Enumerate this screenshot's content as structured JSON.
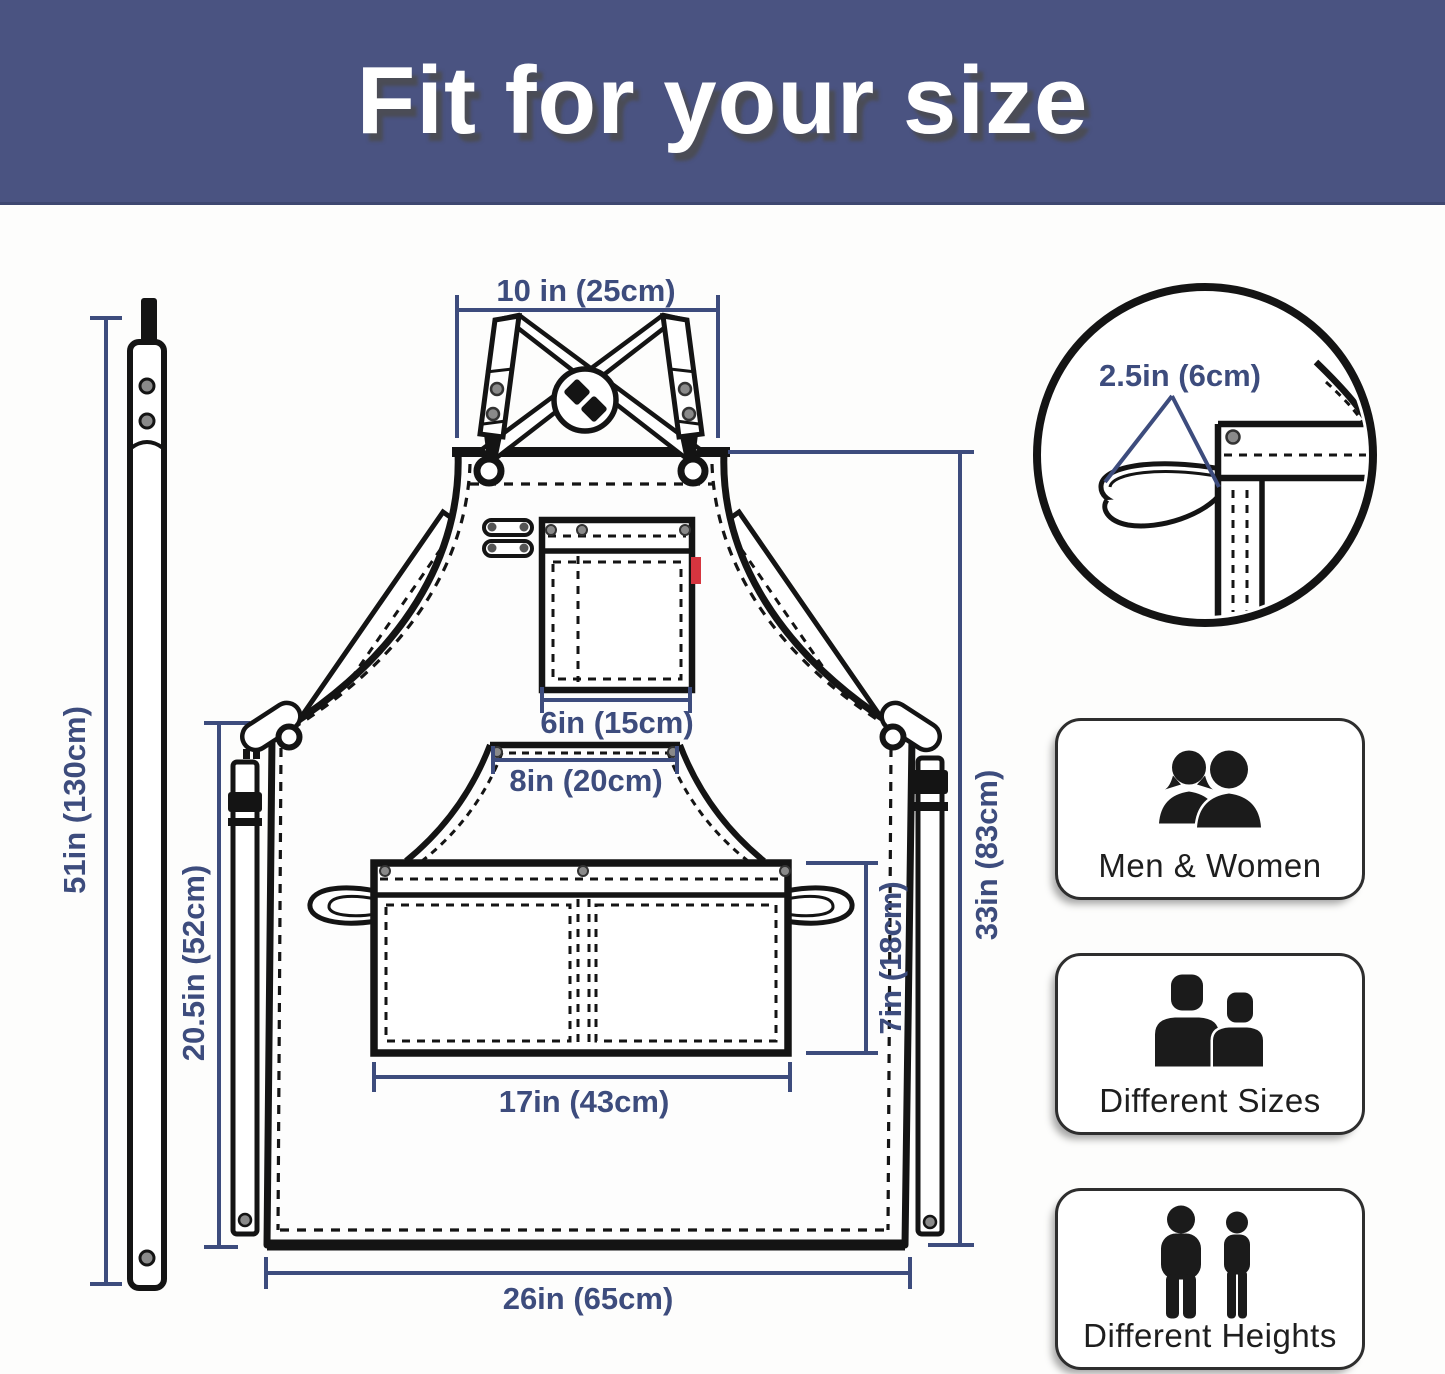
{
  "header": {
    "title": "Fit for your size"
  },
  "colors": {
    "banner_bg": "#4a5381",
    "dimension_navy": "#3d4c7d",
    "line_black": "#141414",
    "rivet_gray": "#8a8a8a",
    "tag_red": "#d6353f"
  },
  "dimensions": {
    "neck_width": "10 in (25cm)",
    "loop_width": "2.5in (6cm)",
    "chest_pocket_width": "6in (15cm)",
    "panel_top_width": "8in (20cm)",
    "strap_length": "51in (130cm)",
    "side_length": "20.5in (52cm)",
    "body_length": "33in (83cm)",
    "pocket_height": "7in (18cm)",
    "pocket_width": "17in (43cm)",
    "bottom_width": "26in (65cm)"
  },
  "features": [
    {
      "label": "Men & Women",
      "icon": "men-women-icon"
    },
    {
      "label": "Different Sizes",
      "icon": "different-sizes-icon"
    },
    {
      "label": "Different Heights",
      "icon": "different-heights-icon"
    }
  ]
}
